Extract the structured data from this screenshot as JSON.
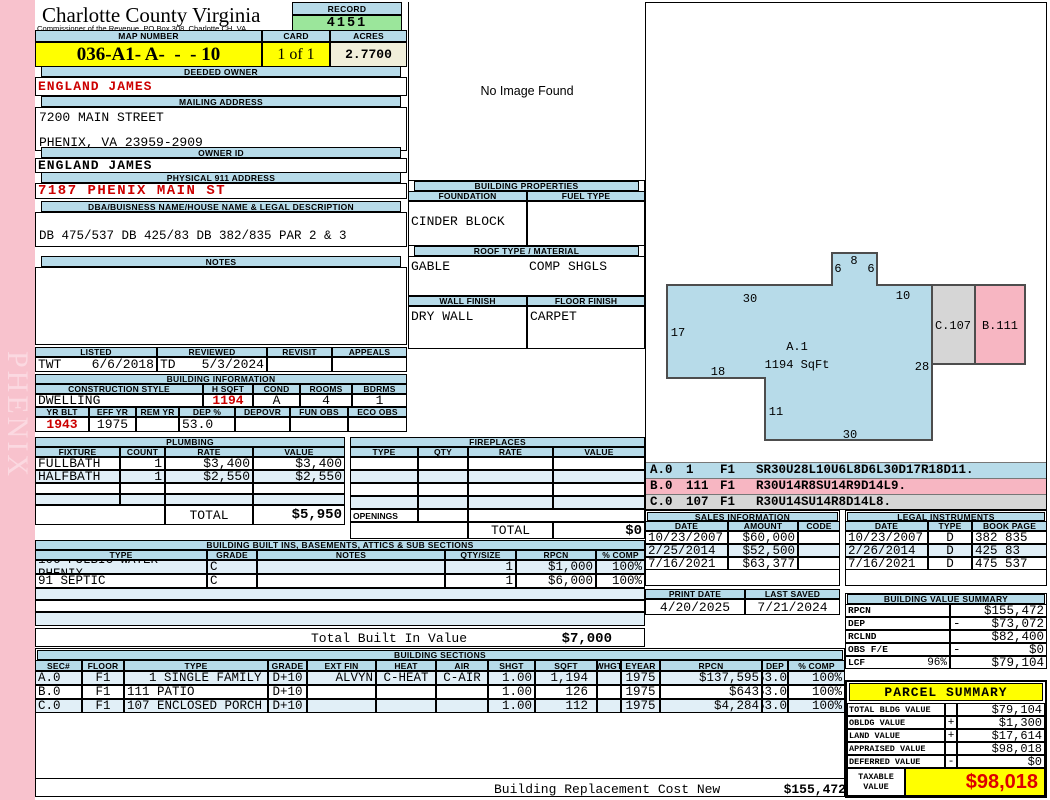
{
  "district": "PHENIX",
  "header": {
    "county": "Charlotte County Virginia",
    "commissioner": "Commissioner of the Revenue, PO Box 308, Charlotte CH, VA",
    "record_label": "RECORD",
    "record": "4151",
    "map_label": "MAP NUMBER",
    "map_number": "036-A1- A-  -  - 10",
    "card_label": "CARD",
    "card": "1 of 1",
    "acres_label": "ACRES",
    "acres": "2.7700"
  },
  "owner": {
    "deeded_label": "DEEDED OWNER",
    "deeded_owner": "ENGLAND JAMES",
    "mailing_label": "MAILING ADDRESS",
    "mailing_line1": "7200 MAIN STREET",
    "mailing_line2": "PHENIX, VA 23959-2909",
    "owner_id_label": "OWNER ID",
    "owner_id": "ENGLAND JAMES",
    "physical_label": "PHYSICAL 911 ADDRESS",
    "physical_address": "7187 PHENIX MAIN ST",
    "legal_label": "DBA/BUISNESS NAME/HOUSE NAME & LEGAL DESCRIPTION",
    "legal_description": "DB 475/537 DB 425/83 DB 382/835 PAR 2 & 3",
    "notes_label": "NOTES"
  },
  "photo": {
    "placeholder": "No Image Found"
  },
  "properties": {
    "title": "BUILDING PROPERTIES",
    "foundation_label": "FOUNDATION",
    "fuel_label": "FUEL TYPE",
    "foundation": "CINDER BLOCK",
    "fuel": "",
    "roof_label": "ROOF TYPE / MATERIAL",
    "roof_type": "GABLE",
    "roof_material": "COMP SHGLS",
    "wall_label": "WALL FINISH",
    "floor_label": "FLOOR FINISH",
    "wall": "DRY WALL",
    "floor": "CARPET"
  },
  "review": {
    "listed_label": "LISTED",
    "listed_by": "TWT",
    "listed_date": "6/6/2018",
    "reviewed_label": "REVIEWED",
    "reviewed_by": "TD",
    "reviewed_date": "5/3/2024",
    "revisit_label": "REVISIT",
    "revisit": "",
    "appeals_label": "APPEALS",
    "appeals": ""
  },
  "building_info": {
    "title": "BUILDING INFORMATION",
    "style_label": "CONSTRUCTION STYLE",
    "hsqft_label": "H SQFT",
    "cond_label": "COND",
    "rooms_label": "ROOMS",
    "bdrms_label": "BDRMS",
    "style": "DWELLING",
    "hsqft": "1194",
    "cond": "A",
    "rooms": "4",
    "bdrms": "1",
    "yrblt_label": "YR BLT",
    "effyr_label": "EFF YR",
    "remyr_label": "REM YR",
    "dep_label": "DEP %",
    "depovr_label": "DEPOVR",
    "funobs_label": "FUN OBS",
    "ecoobs_label": "ECO OBS",
    "yrblt": "1943",
    "effyr": "1975",
    "remyr": "",
    "dep": "53.0",
    "depovr": "",
    "funobs": "",
    "ecoobs": ""
  },
  "plumbing": {
    "title": "PLUMBING",
    "cols": [
      "FIXTURE",
      "COUNT",
      "RATE",
      "VALUE"
    ],
    "rows": [
      {
        "fixture": "FULLBATH",
        "count": "1",
        "rate": "$3,400",
        "value": "$3,400"
      },
      {
        "fixture": "HALFBATH",
        "count": "1",
        "rate": "$2,550",
        "value": "$2,550"
      }
    ],
    "total_label": "TOTAL",
    "total": "$5,950"
  },
  "fireplaces": {
    "title": "FIREPLACES",
    "cols": [
      "TYPE",
      "QTY",
      "RATE",
      "VALUE"
    ],
    "openings_label": "OPENINGS",
    "total_label": "TOTAL",
    "total": "$0"
  },
  "built_ins": {
    "title": "BUILDING BUILT INS, BASEMENTS, ATTICS & SUB SECTIONS",
    "cols": [
      "TYPE",
      "GRADE",
      "NOTES",
      "QTY/SIZE",
      "RPCN",
      "% COMP"
    ],
    "rows": [
      {
        "type": "106 PULBIC WATER PHENIX",
        "grade": "C",
        "notes": "",
        "qty": "1",
        "rpcn": "$1,000",
        "comp": "100%"
      },
      {
        "type": "91 SEPTIC",
        "grade": "C",
        "notes": "",
        "qty": "1",
        "rpcn": "$6,000",
        "comp": "100%"
      }
    ],
    "total_label": "Total Built In Value",
    "total": "$7,000"
  },
  "sections": {
    "title": "BUILDING SECTIONS",
    "cols": [
      "SEC#",
      "FLOOR",
      "TYPE",
      "GRADE",
      "EXT FIN",
      "HEAT",
      "AIR",
      "SHGT",
      "SQFT",
      "WHGT",
      "EYEAR",
      "RPCN",
      "DEP",
      "% COMP"
    ],
    "rows": [
      {
        "sec": "A.0",
        "floor": "F1",
        "type": "1 SINGLE FAMILY",
        "grade": "D+10",
        "extfin": "ALVYN",
        "heat": "C-HEAT",
        "air": "C-AIR",
        "shgt": "1.00",
        "sqft": "1,194",
        "whgt": "",
        "eyear": "1975",
        "rpcn": "$137,595",
        "dep": "53.0",
        "comp": "100%"
      },
      {
        "sec": "B.0",
        "floor": "F1",
        "type": "111 PATIO",
        "grade": "D+10",
        "extfin": "",
        "heat": "",
        "air": "",
        "shgt": "1.00",
        "sqft": "126",
        "whgt": "",
        "eyear": "1975",
        "rpcn": "$643",
        "dep": "53.0",
        "comp": "100%"
      },
      {
        "sec": "C.0",
        "floor": "F1",
        "type": "107 ENCLOSED PORCH",
        "grade": "D+10",
        "extfin": "",
        "heat": "",
        "air": "",
        "shgt": "1.00",
        "sqft": "112",
        "whgt": "",
        "eyear": "1975",
        "rpcn": "$4,284",
        "dep": "53.0",
        "comp": "100%"
      }
    ],
    "footer_label": "Building Replacement Cost New",
    "footer_value": "$155,472"
  },
  "sketch": {
    "area_label": "A.1",
    "area_sqft": "1194 SqFt",
    "b_label": "B.111",
    "c_label": "C.107",
    "dims": {
      "top": "30",
      "bump_left": "6",
      "bump_top": "8",
      "bump_right": "6",
      "top_right": "10",
      "left": "17",
      "notch": "18",
      "right": "28",
      "step": "11",
      "bottom": "30"
    },
    "codes": [
      {
        "sec": "A.0",
        "num": "1",
        "floor": "F1",
        "code": "SR30U28L10U6L8D6L30D17R18D11."
      },
      {
        "sec": "B.0",
        "num": "111",
        "floor": "F1",
        "code": "R30U14R8SU14R9D14L9."
      },
      {
        "sec": "C.0",
        "num": "107",
        "floor": "F1",
        "code": "R30U14SU14R8D14L8."
      }
    ],
    "colors": {
      "section_a": "#b7dbe9",
      "section_b": "#f7b6c2",
      "section_c": "#d6d6d6"
    }
  },
  "sales": {
    "title": "SALES INFORMATION",
    "cols": [
      "DATE",
      "AMOUNT",
      "CODE"
    ],
    "rows": [
      {
        "date": "10/23/2007",
        "amount": "$60,000",
        "code": ""
      },
      {
        "date": "2/25/2014",
        "amount": "$52,500",
        "code": ""
      },
      {
        "date": "7/16/2021",
        "amount": "$63,377",
        "code": ""
      }
    ]
  },
  "legal": {
    "title": "LEGAL INSTRUMENTS",
    "cols": [
      "DATE",
      "TYPE",
      "BOOK PAGE"
    ],
    "rows": [
      {
        "date": "10/23/2007",
        "type": "D",
        "book": "382 835"
      },
      {
        "date": "2/26/2014",
        "type": "D",
        "book": "425 83"
      },
      {
        "date": "7/16/2021",
        "type": "D",
        "book": "475 537"
      }
    ]
  },
  "print_info": {
    "print_label": "PRINT DATE",
    "print_date": "4/20/2025",
    "saved_label": "LAST SAVED",
    "saved_date": "7/21/2024"
  },
  "value_summary": {
    "title": "BUILDING VALUE SUMMARY",
    "rows": [
      {
        "label": "RPCN",
        "pct": "",
        "sign": "",
        "value": "$155,472"
      },
      {
        "label": "DEP",
        "pct": "",
        "sign": "-",
        "value": "$73,072"
      },
      {
        "label": "RCLND",
        "pct": "",
        "sign": "",
        "value": "$82,400"
      },
      {
        "label": "OBS F/E",
        "pct": "",
        "sign": "-",
        "value": "$0"
      },
      {
        "label": "LCF",
        "pct": "96%",
        "sign": "",
        "value": "$79,104"
      }
    ]
  },
  "parcel": {
    "title": "PARCEL SUMMARY",
    "rows": [
      {
        "label": "TOTAL BLDG VALUE",
        "sign": "",
        "value": "$79,104"
      },
      {
        "label": "OBLDG VALUE",
        "sign": "+",
        "value": "$1,300"
      },
      {
        "label": "LAND VALUE",
        "sign": "+",
        "value": "$17,614"
      },
      {
        "label": "APPRAISED VALUE",
        "sign": "",
        "value": "$98,018"
      },
      {
        "label": "DEFERRED VALUE",
        "sign": "-",
        "value": "$0"
      }
    ],
    "taxable_label1": "TAXABLE",
    "taxable_label2": "VALUE",
    "taxable": "$98,018",
    "accent": "#ffff00",
    "taxable_color": "#dd0000"
  }
}
